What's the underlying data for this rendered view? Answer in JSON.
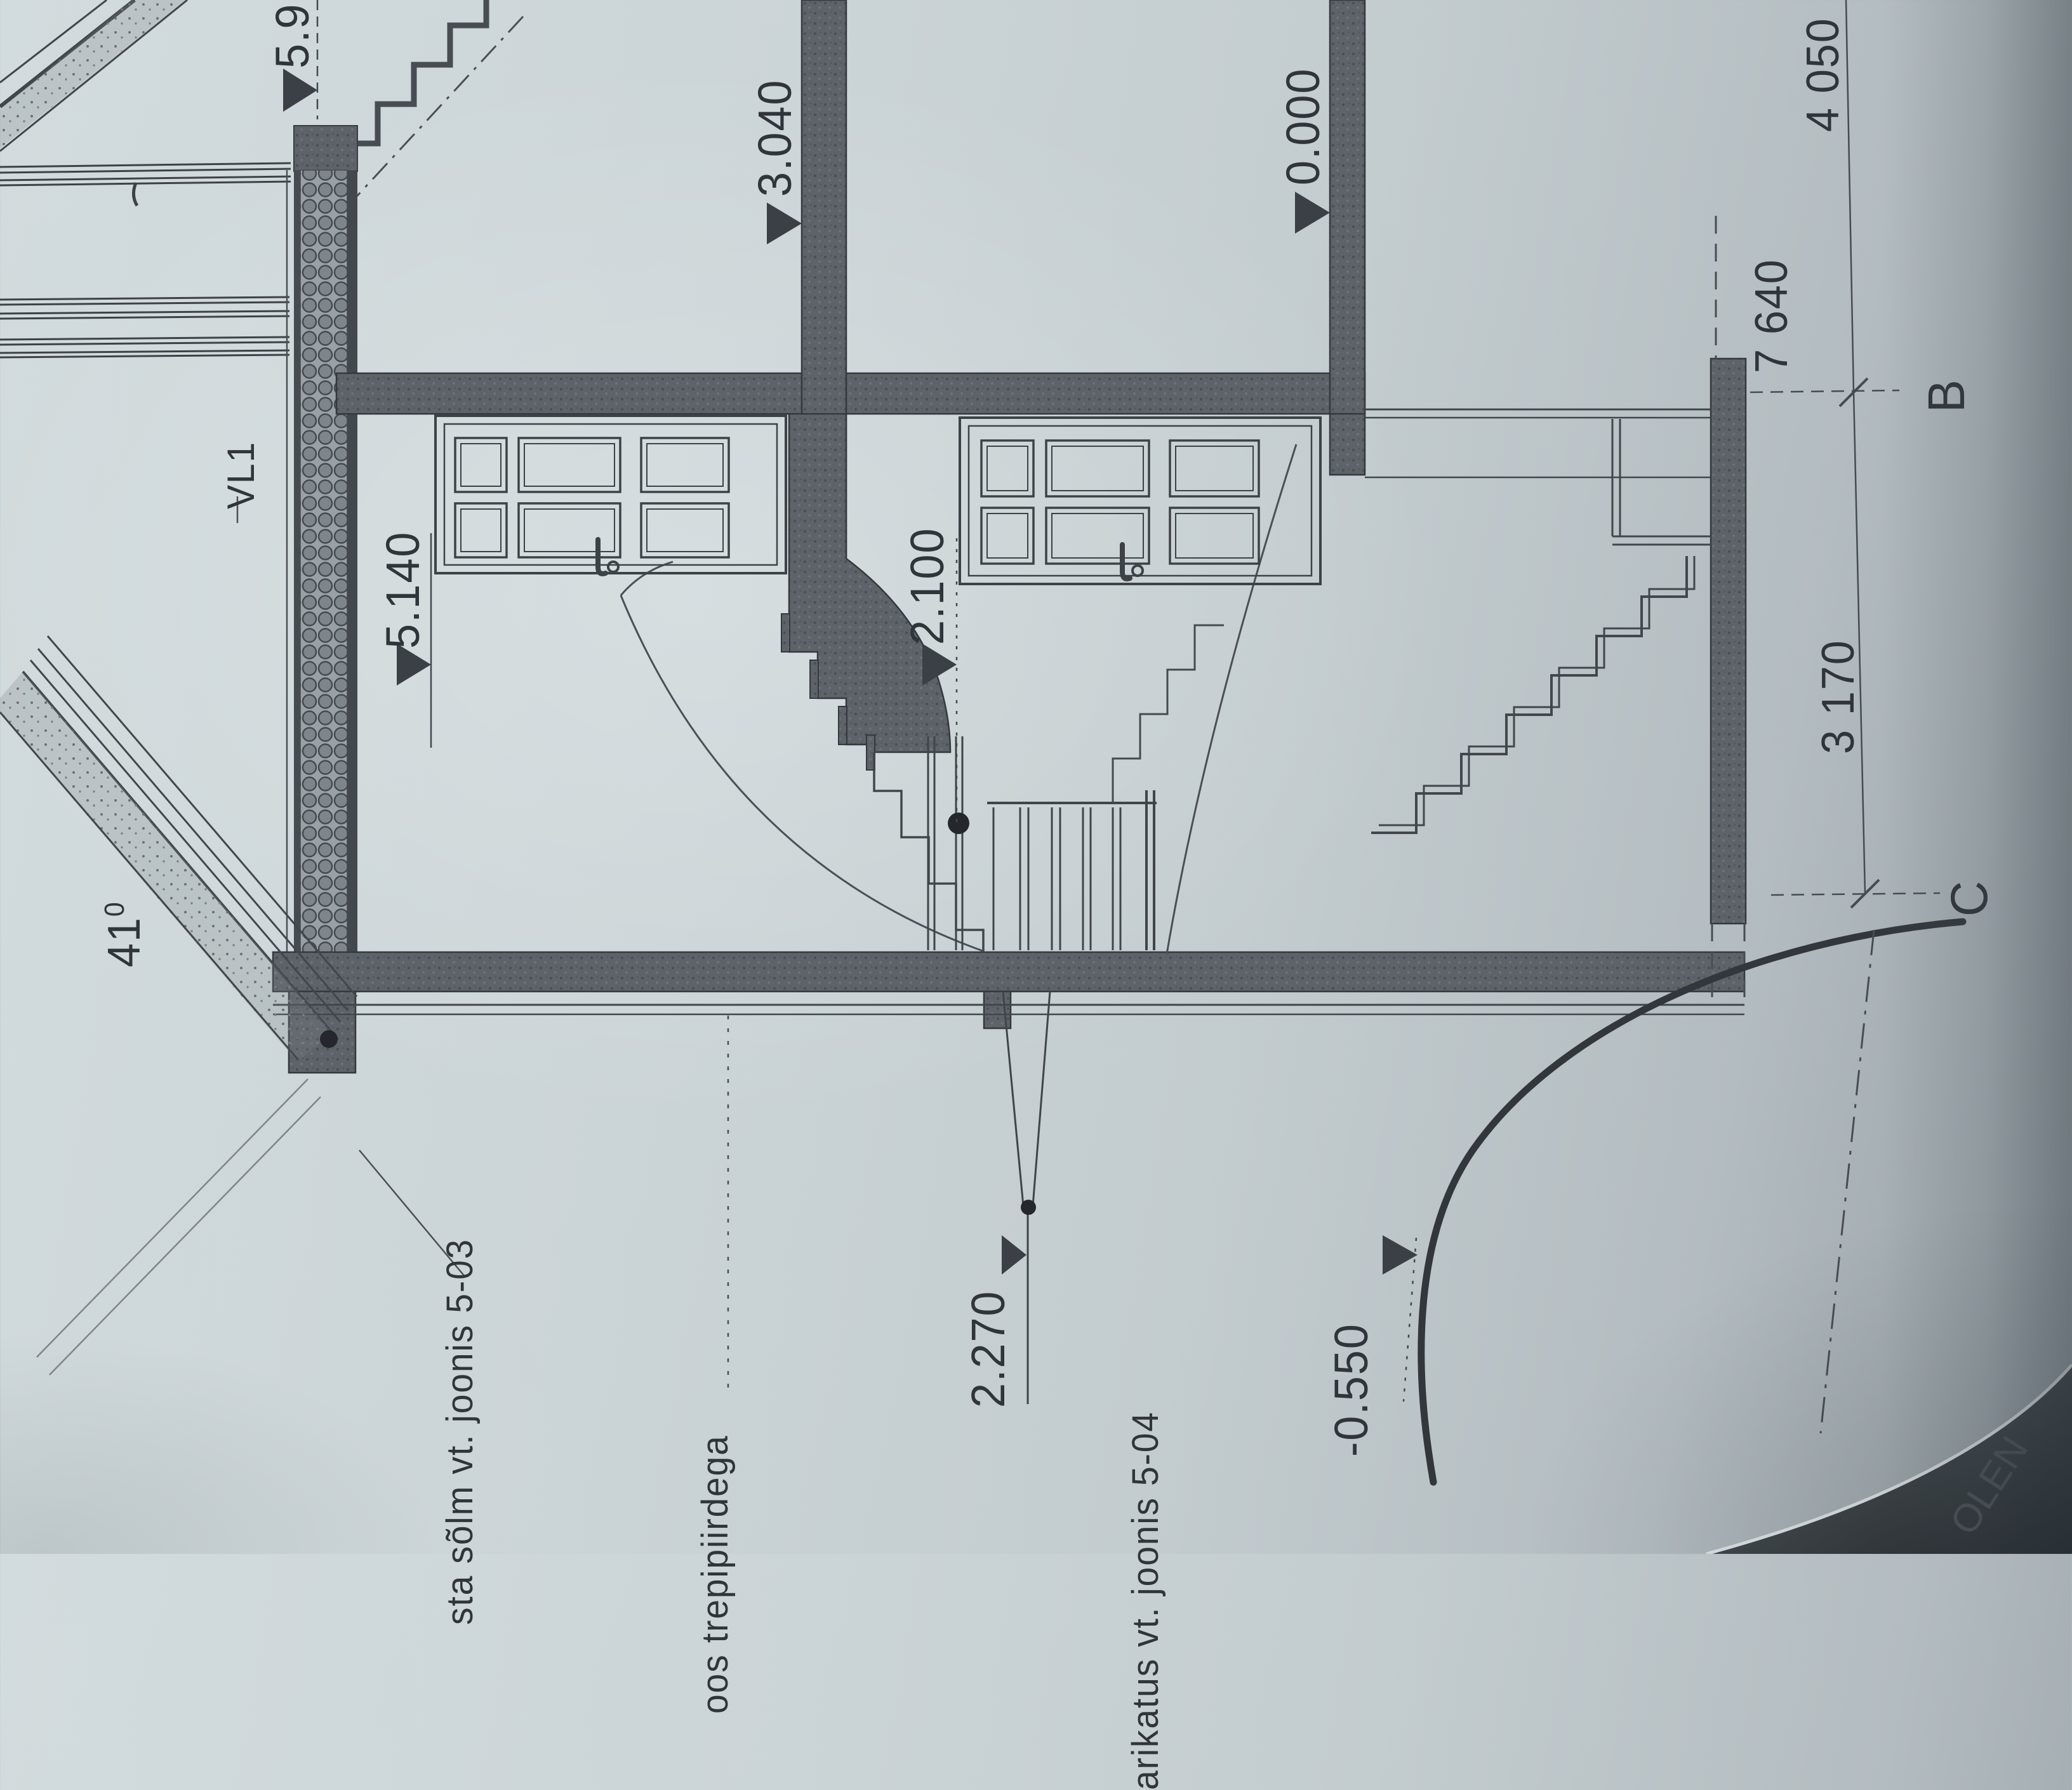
{
  "document": {
    "kind": "architectural building section drawing (photographed paper, rotated 90°)",
    "language": "Estonian"
  },
  "colors": {
    "paper": "#c9d2d5",
    "ink": "#3c4247",
    "wall_fill": "#5b6167",
    "shadow": "#2c3136"
  },
  "levels": {
    "l59": "5.9",
    "l3040": "3.040",
    "l0000": "0.000",
    "l5140": "5.140",
    "l2100": "2.100",
    "l2270": "2.270",
    "lm0550": "-0.550"
  },
  "dimensions": {
    "d4050": "4 050",
    "d7640": "7 640",
    "d3170": "3 170"
  },
  "grid": {
    "axisB": "B",
    "axisC": "C"
  },
  "roof_angle": {
    "value": "41",
    "sup": "0"
  },
  "tags": {
    "vl1": "VL1"
  },
  "notes": {
    "note1": "sta sõlm vt. joonis 5-03",
    "note2": "oos trepipiirdega",
    "note3": "arikatus vt. joonis 5-04",
    "corner": "OLEN"
  }
}
